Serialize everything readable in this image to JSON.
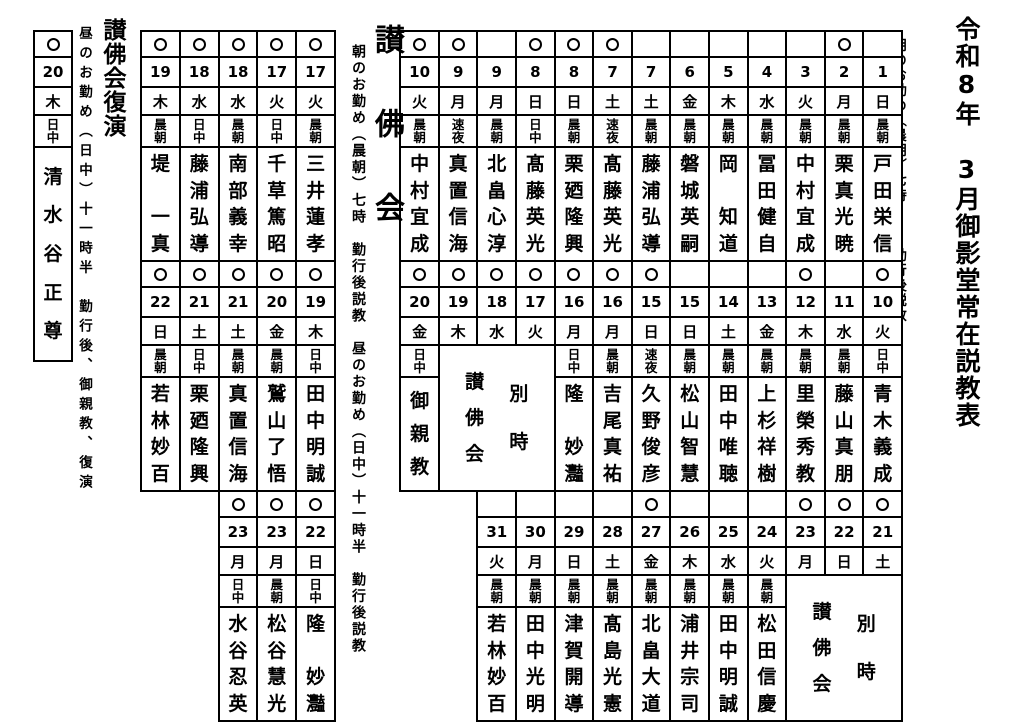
{
  "colors": {
    "ink": "#000000",
    "background": "#ffffff"
  },
  "page": {
    "title": "令和8年　3月御影堂常在説教表",
    "title_note_morning": "朝のお勤め（晨朝）七時　　　勤行後説教",
    "title_note_noon": "昼のお勤め（日中・速夜）十二時　勤行後説教"
  },
  "main_table": {
    "blocks": [
      {
        "columns": [
          {
            "circle": false,
            "date": "1",
            "day": "日",
            "time": "晨朝",
            "name": "戸田栄信"
          },
          {
            "circle": true,
            "date": "2",
            "day": "月",
            "time": "晨朝",
            "name": "栗真光暁"
          },
          {
            "circle": false,
            "date": "3",
            "day": "火",
            "time": "晨朝",
            "name": "中村宜成"
          },
          {
            "circle": false,
            "date": "4",
            "day": "水",
            "time": "晨朝",
            "name": "冨田健自"
          },
          {
            "circle": false,
            "date": "5",
            "day": "木",
            "time": "晨朝",
            "name": "岡　知道"
          },
          {
            "circle": false,
            "date": "6",
            "day": "金",
            "time": "晨朝",
            "name": "磐城英嗣"
          },
          {
            "circle": false,
            "date": "7",
            "day": "土",
            "time": "晨朝",
            "name": "藤浦弘導"
          },
          {
            "circle": true,
            "date": "7",
            "day": "土",
            "time": "速夜",
            "name": "髙藤英光"
          },
          {
            "circle": true,
            "date": "8",
            "day": "日",
            "time": "晨朝",
            "name": "栗廼隆興"
          },
          {
            "circle": true,
            "date": "8",
            "day": "日",
            "time": "日中",
            "name": "髙藤英光"
          },
          {
            "circle": false,
            "date": "9",
            "day": "月",
            "time": "晨朝",
            "name": "北畠心淳"
          },
          {
            "circle": true,
            "date": "9",
            "day": "月",
            "time": "速夜",
            "name": "真置信海"
          },
          {
            "circle": true,
            "date": "10",
            "day": "火",
            "time": "晨朝",
            "name": "中村宜成"
          }
        ]
      },
      {
        "columns": [
          {
            "circle": true,
            "date": "10",
            "day": "火",
            "time": "日中",
            "name": "青木義成"
          },
          {
            "circle": false,
            "date": "11",
            "day": "水",
            "time": "晨朝",
            "name": "藤山真朋"
          },
          {
            "circle": true,
            "date": "12",
            "day": "木",
            "time": "晨朝",
            "name": "里榮秀教"
          },
          {
            "circle": false,
            "date": "13",
            "day": "金",
            "time": "晨朝",
            "name": "上杉祥樹"
          },
          {
            "circle": false,
            "date": "14",
            "day": "土",
            "time": "晨朝",
            "name": "田中唯聴"
          },
          {
            "circle": false,
            "date": "15",
            "day": "日",
            "time": "晨朝",
            "name": "松山智慧"
          },
          {
            "circle": true,
            "date": "15",
            "day": "日",
            "time": "速夜",
            "name": "久野俊彦"
          },
          {
            "circle": true,
            "date": "16",
            "day": "月",
            "time": "晨朝",
            "name": "吉尾真祐"
          },
          {
            "circle": true,
            "date": "16",
            "day": "月",
            "time": "日中",
            "name": "隆　妙灩"
          },
          {
            "circle": true,
            "date": "17",
            "day": "火",
            "time": "",
            "name": "",
            "merged": true
          },
          {
            "circle": true,
            "date": "18",
            "day": "水",
            "time": "",
            "name": "",
            "merged": true
          },
          {
            "circle": true,
            "date": "19",
            "day": "木",
            "time": "",
            "name": "",
            "merged": true
          },
          {
            "circle": true,
            "date": "20",
            "day": "金",
            "time": "日中",
            "name": "御親教"
          }
        ],
        "merged": {
          "start": 9,
          "span": 3,
          "labels": [
            "別時",
            "讃佛会"
          ]
        }
      },
      {
        "columns": [
          {
            "circle": true,
            "date": "21",
            "day": "土",
            "time": "",
            "name": "",
            "merged": true
          },
          {
            "circle": true,
            "date": "22",
            "day": "日",
            "time": "",
            "name": "",
            "merged": true
          },
          {
            "circle": true,
            "date": "23",
            "day": "月",
            "time": "",
            "name": "",
            "merged": true
          },
          {
            "circle": false,
            "date": "24",
            "day": "火",
            "time": "晨朝",
            "name": "松田信慶"
          },
          {
            "circle": false,
            "date": "25",
            "day": "水",
            "time": "晨朝",
            "name": "田中明誠"
          },
          {
            "circle": false,
            "date": "26",
            "day": "木",
            "time": "晨朝",
            "name": "浦井宗司"
          },
          {
            "circle": true,
            "date": "27",
            "day": "金",
            "time": "晨朝",
            "name": "北畠大道"
          },
          {
            "circle": false,
            "date": "28",
            "day": "土",
            "time": "晨朝",
            "name": "髙島光憲"
          },
          {
            "circle": false,
            "date": "29",
            "day": "日",
            "time": "晨朝",
            "name": "津賀開導"
          },
          {
            "circle": false,
            "date": "30",
            "day": "月",
            "time": "晨朝",
            "name": "田中光明"
          },
          {
            "circle": false,
            "date": "31",
            "day": "火",
            "time": "晨朝",
            "name": "若林妙百"
          }
        ],
        "merged": {
          "start": 0,
          "span": 3,
          "labels": [
            "別時",
            "讃佛会"
          ]
        }
      }
    ]
  },
  "sanbutsukai": {
    "heading": "讃　佛　会",
    "note": "朝のお勤め（晨朝）七時　勤行後説教　昼のお勤め（日中）十一時半　勤行後説教",
    "blocks": [
      {
        "columns": [
          {
            "circle": true,
            "date": "17",
            "day": "火",
            "time": "晨朝",
            "name": "三井蓮孝"
          },
          {
            "circle": true,
            "date": "17",
            "day": "火",
            "time": "日中",
            "name": "千草篤昭"
          },
          {
            "circle": true,
            "date": "18",
            "day": "水",
            "time": "晨朝",
            "name": "南部義幸"
          },
          {
            "circle": true,
            "date": "18",
            "day": "水",
            "time": "日中",
            "name": "藤浦弘導"
          },
          {
            "circle": true,
            "date": "19",
            "day": "木",
            "time": "晨朝",
            "name": "堤　一真"
          }
        ]
      },
      {
        "columns": [
          {
            "circle": true,
            "date": "19",
            "day": "木",
            "time": "日中",
            "name": "田中明誠"
          },
          {
            "circle": true,
            "date": "20",
            "day": "金",
            "time": "晨朝",
            "name": "鷲山了悟"
          },
          {
            "circle": true,
            "date": "21",
            "day": "土",
            "time": "晨朝",
            "name": "真置信海"
          },
          {
            "circle": true,
            "date": "21",
            "day": "土",
            "time": "日中",
            "name": "栗廼隆興"
          },
          {
            "circle": true,
            "date": "22",
            "day": "日",
            "time": "晨朝",
            "name": "若林妙百"
          }
        ]
      },
      {
        "columns": [
          {
            "circle": true,
            "date": "22",
            "day": "日",
            "time": "日中",
            "name": "隆　妙灩"
          },
          {
            "circle": true,
            "date": "23",
            "day": "月",
            "time": "晨朝",
            "name": "松谷慧光"
          },
          {
            "circle": true,
            "date": "23",
            "day": "月",
            "time": "日中",
            "name": "水谷忍英"
          }
        ]
      }
    ]
  },
  "fukuen": {
    "heading": "讃佛会復演",
    "note": "昼のお勤め（日中）十一時半　勤行後、御親教、復演",
    "blocks": [
      {
        "columns": [
          {
            "circle": true,
            "date": "20",
            "day": "木",
            "time": "日中",
            "name": "清水谷正尊"
          }
        ]
      }
    ]
  }
}
